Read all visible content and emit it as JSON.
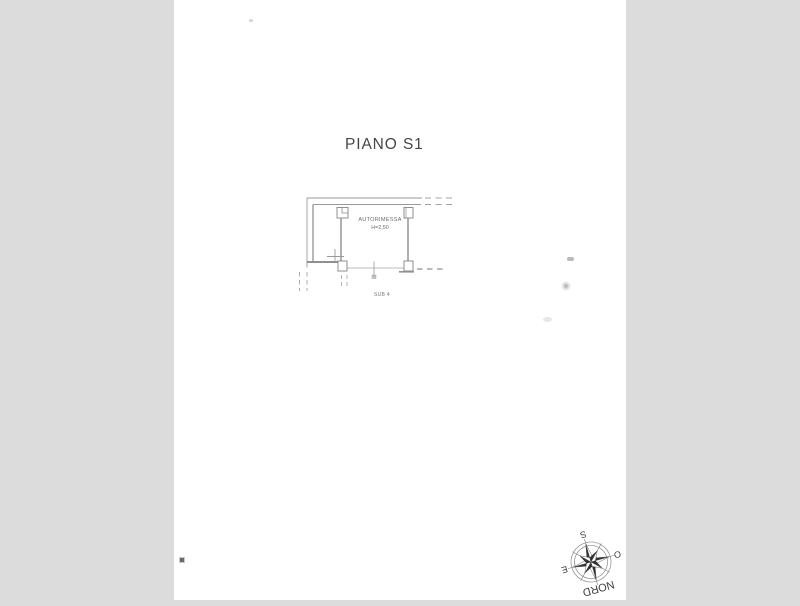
{
  "document": {
    "title": "PIANO S1"
  },
  "floor_plan": {
    "room_label": "AUTORIMESSA",
    "height_label": "H=2,50",
    "unit_label": "SUB 4"
  },
  "compass": {
    "north_label": "NORD",
    "south_label": "S",
    "east_label": "E",
    "west_label": "O"
  },
  "colors": {
    "background": "#dcdcdc",
    "paper": "#ffffff",
    "plan_line": "#969696",
    "plan_text": "#6e6e6e",
    "title_text": "#474747",
    "compass_dark": "#2f2f2f"
  }
}
